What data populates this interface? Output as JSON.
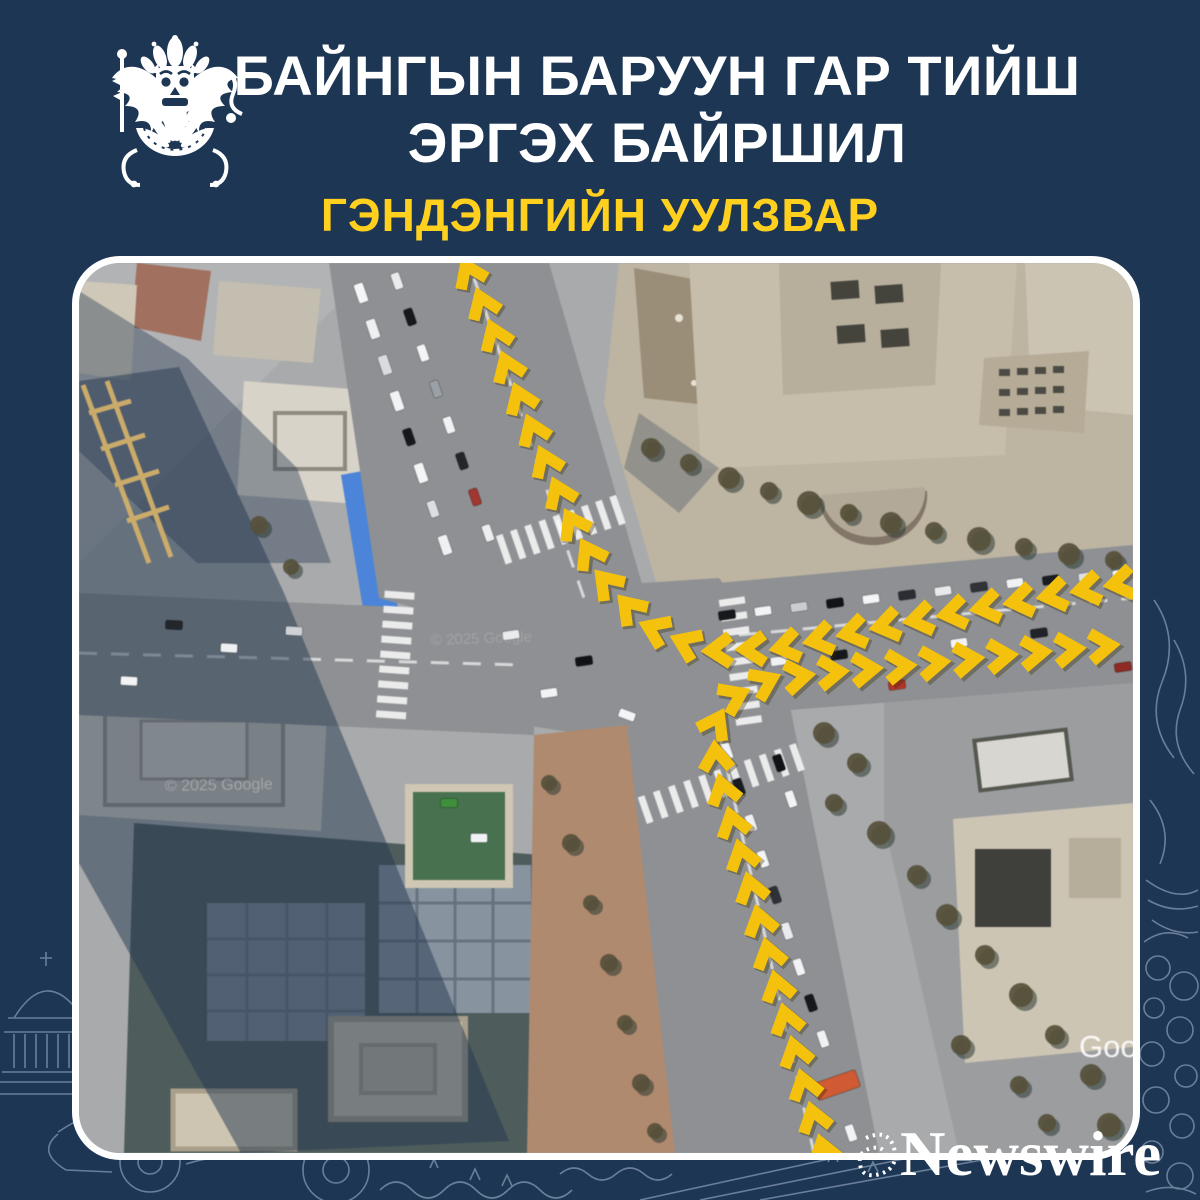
{
  "page": {
    "background_color": "#1d3654",
    "accent_yellow": "#ffd01e",
    "chevron_color": "#f4c20c",
    "lineart_color": "#c7d7ee"
  },
  "header": {
    "emblem": "mongolian-traffic-police-crest",
    "title_line1": "БАЙНГЫН БАРУУН ГАР ТИЙШ",
    "title_line2": "ЭРГЭХ БАЙРШИЛ",
    "subtitle": "ГЭНДЭНГИЙН УУЛЗВАР"
  },
  "map": {
    "type": "satellite-imagery",
    "copyright": "© 2025 Google",
    "attribution_partial": "Goog",
    "routes": [
      {
        "name": "east-approach-right-turn-to-north",
        "direction": "west-then-north",
        "spacing": 34,
        "points": [
          [
            1054,
            318
          ],
          [
            930,
            340
          ],
          [
            810,
            362
          ],
          [
            700,
            385
          ],
          [
            625,
            388
          ],
          [
            566,
            362
          ],
          [
            524,
            316
          ],
          [
            492,
            258
          ],
          [
            462,
            188
          ],
          [
            430,
            108
          ],
          [
            400,
            32
          ],
          [
            372,
            -30
          ]
        ]
      },
      {
        "name": "south-approach-right-turn-to-east",
        "direction": "north-then-east",
        "spacing": 34,
        "points": [
          [
            748,
            900
          ],
          [
            724,
            818
          ],
          [
            700,
            730
          ],
          [
            676,
            640
          ],
          [
            654,
            562
          ],
          [
            638,
            506
          ],
          [
            634,
            466
          ],
          [
            650,
            436
          ],
          [
            688,
            418
          ],
          [
            745,
            410
          ],
          [
            825,
            403
          ],
          [
            910,
            394
          ],
          [
            995,
            386
          ],
          [
            1054,
            380
          ]
        ]
      }
    ]
  },
  "watermark": {
    "brand": "Newswire"
  }
}
